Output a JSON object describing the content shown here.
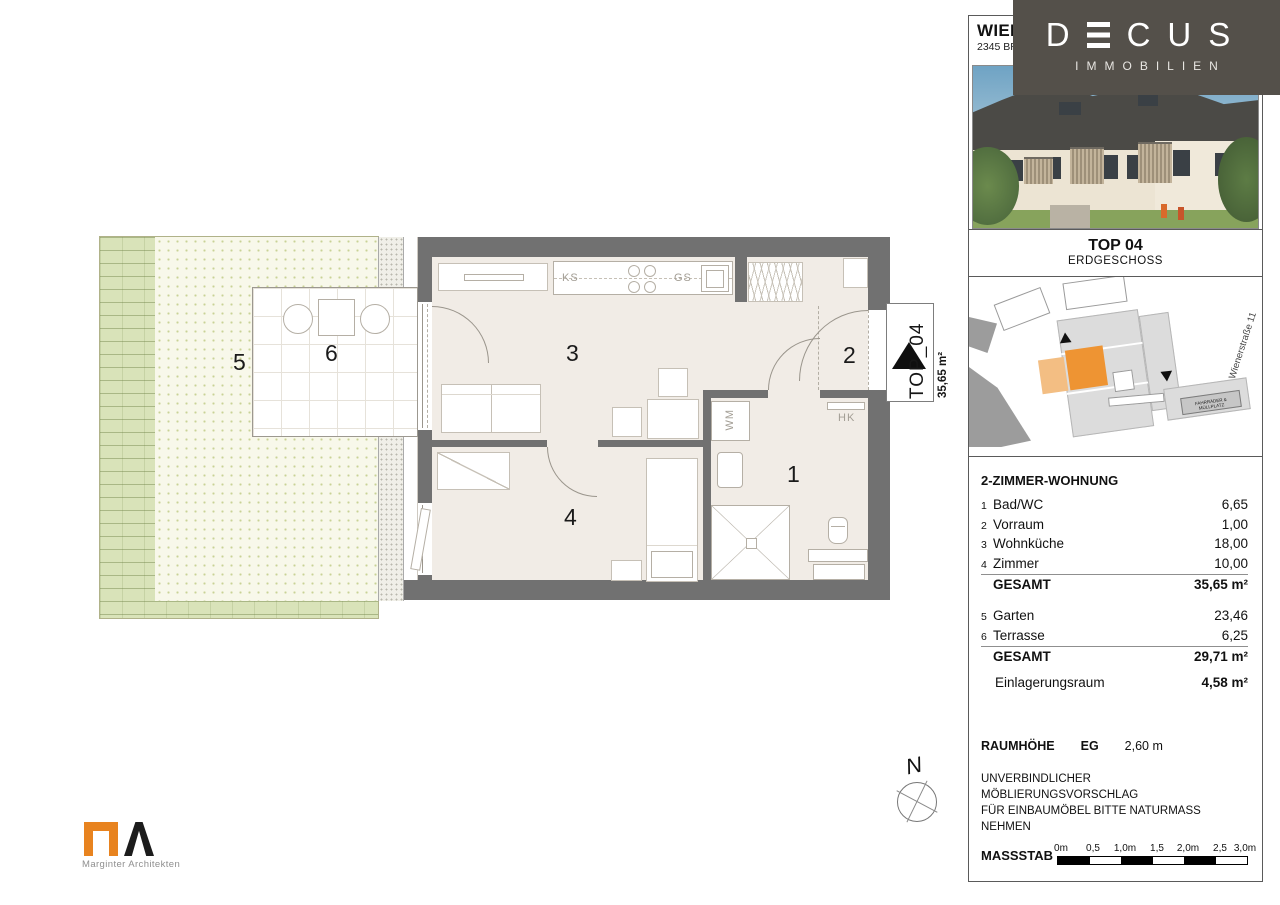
{
  "header": {
    "city_line": "WIEN",
    "address_line": "2345 BR"
  },
  "brand": {
    "letter_d": "D",
    "letters_cus": "CUS",
    "subtitle": "IMMOBILIEN"
  },
  "unit_card": {
    "title": "TOP 04",
    "subtitle": "ERDGESCHOSS"
  },
  "site_plan": {
    "street": "Wienerstraße 11",
    "bike_box": "FAHRRÄDER & MÜLLPLATZ"
  },
  "area_table": {
    "title": "2-ZIMMER-WOHNUNG",
    "indoor_rows": [
      {
        "num": "1",
        "name": "Bad/WC",
        "area": "6,65"
      },
      {
        "num": "2",
        "name": "Vorraum",
        "area": "1,00"
      },
      {
        "num": "3",
        "name": "Wohnküche",
        "area": "18,00"
      },
      {
        "num": "4",
        "name": "Zimmer",
        "area": "10,00"
      }
    ],
    "indoor_total_label": "GESAMT",
    "indoor_total_value": "35,65 m²",
    "outdoor_rows": [
      {
        "num": "5",
        "name": "Garten",
        "area": "23,46"
      },
      {
        "num": "6",
        "name": "Terrasse",
        "area": "6,25"
      }
    ],
    "outdoor_total_label": "GESAMT",
    "outdoor_total_value": "29,71 m²",
    "storage_label": "Einlagerungsraum",
    "storage_value": "4,58 m²"
  },
  "notes": {
    "height_label": "RAUMHÖHE",
    "height_floor": "EG",
    "height_value": "2,60 m",
    "disclaimer1": "UNVERBINDLICHER MÖBLIERUNGSVORSCHLAG",
    "disclaimer2": "FÜR EINBAUMÖBEL BITTE NATURMASS NEHMEN"
  },
  "scale_bar": {
    "label": "MASSSTAB",
    "ticks": [
      "0m",
      "0,5",
      "1,0m",
      "1,5",
      "2,0m",
      "2,5",
      "3,0m"
    ]
  },
  "floor_plan": {
    "room_numbers": {
      "bath": "1",
      "hall": "2",
      "living": "3",
      "bedroom": "4",
      "garden": "5",
      "terrace": "6"
    },
    "fixture_labels": {
      "fridge": "KS",
      "dishwasher": "GS",
      "washer": "WM",
      "radiator": "HK"
    },
    "entry_marker": {
      "unit": "TOP_04",
      "area": "35,65 m²"
    },
    "north_letter": "N"
  },
  "architect": {
    "name": "Marginter Architekten"
  },
  "colors": {
    "accent_orange": "#EE9433",
    "brand_brown": "#54504A",
    "wall_gray": "#717171"
  }
}
